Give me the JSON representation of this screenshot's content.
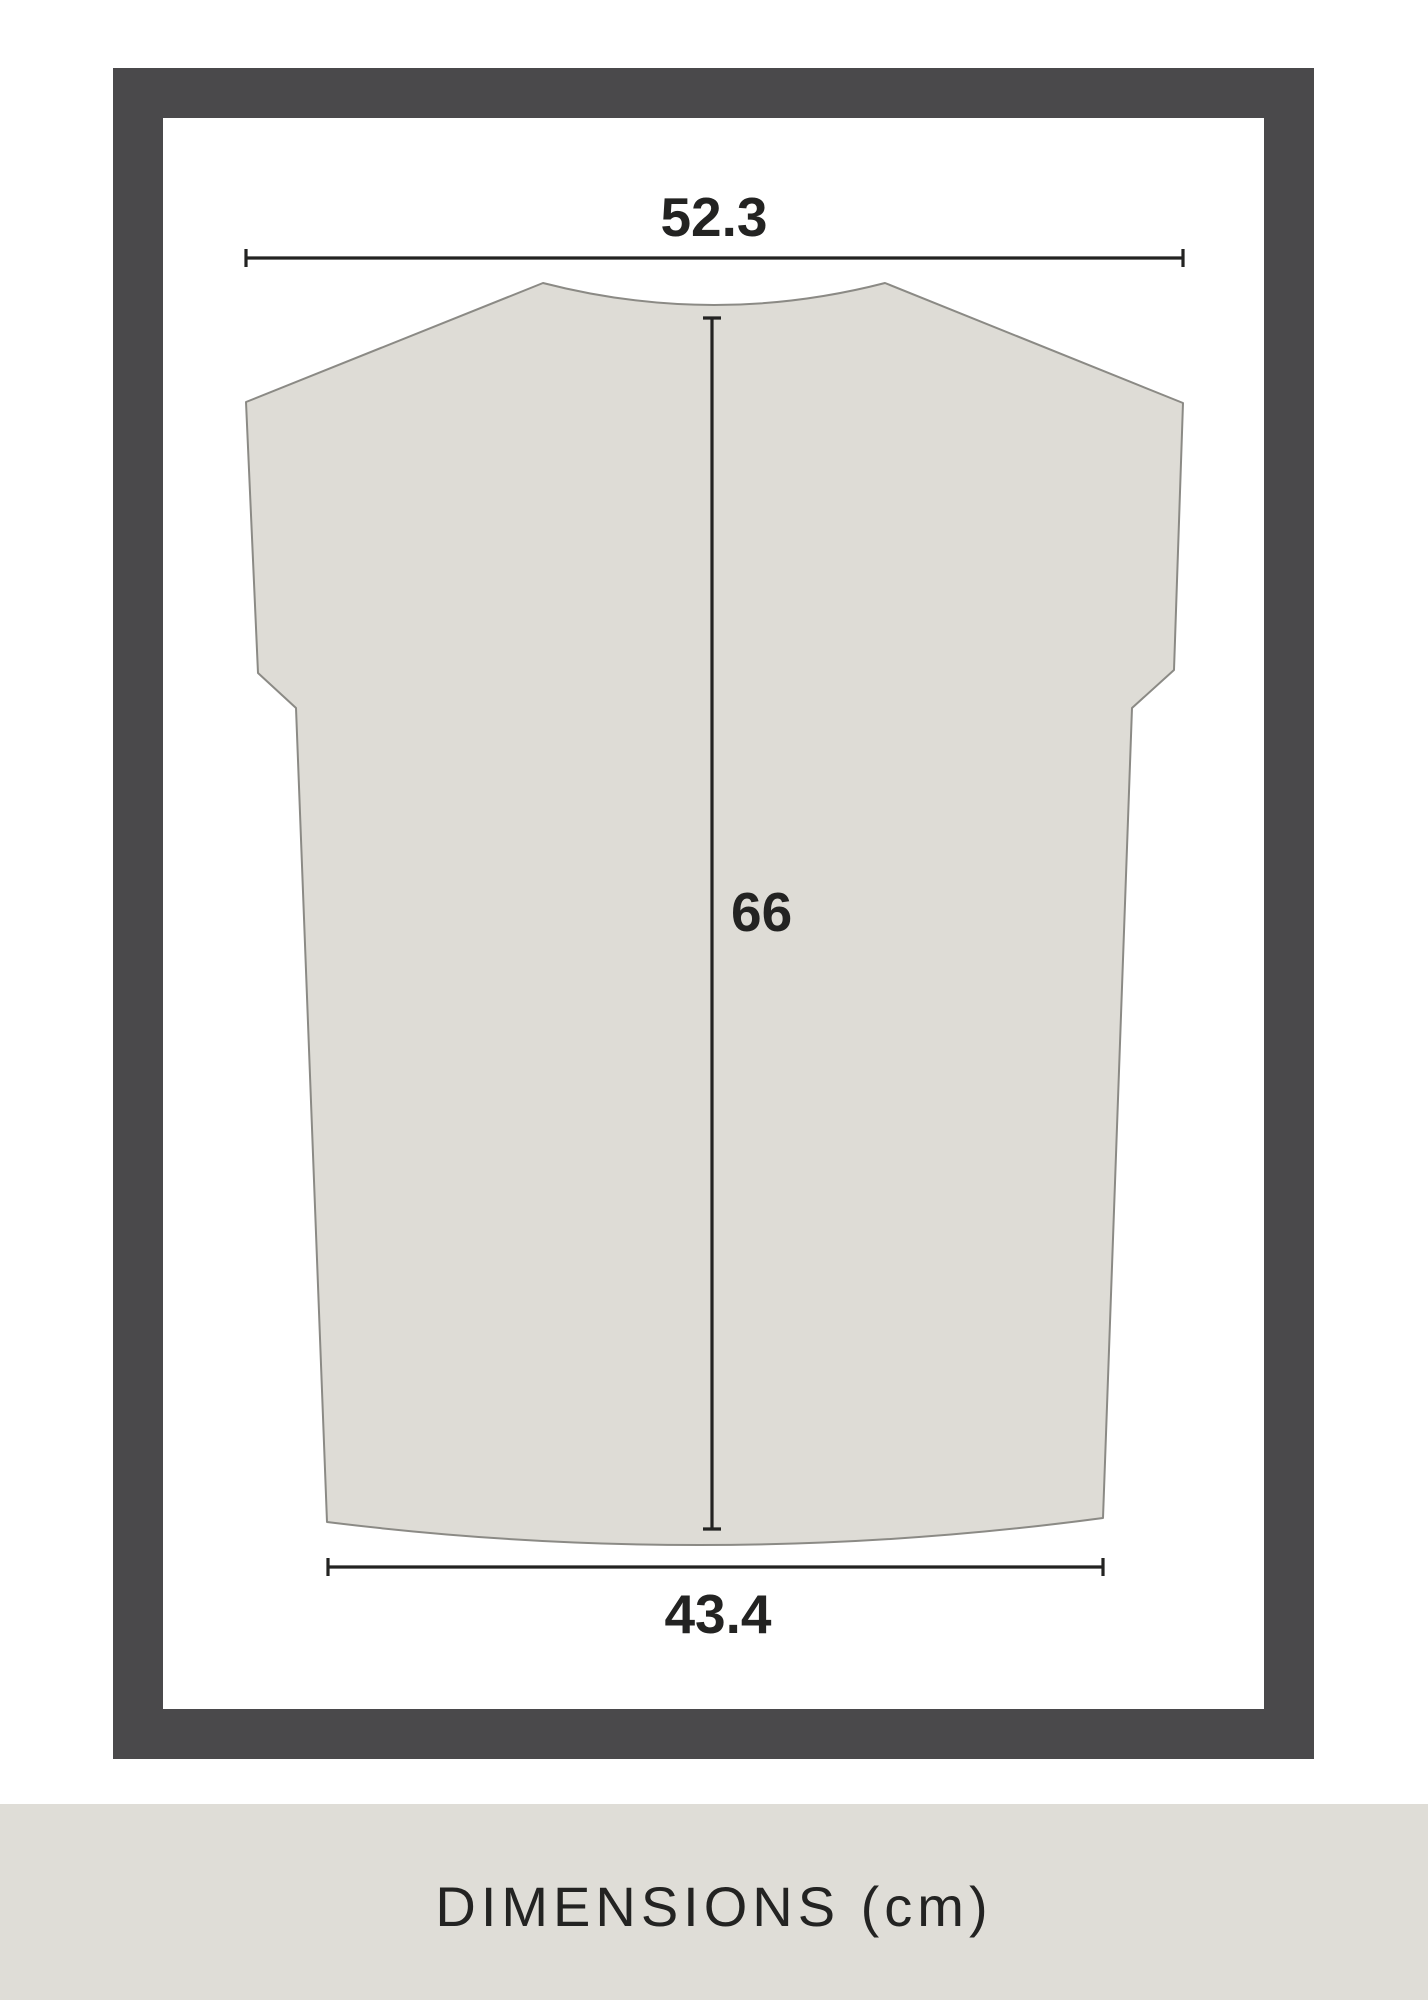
{
  "diagram": {
    "measurements": {
      "top_width": "52.3",
      "length": "66",
      "bottom_width": "43.4"
    },
    "unit": "cm"
  },
  "footer": {
    "title": "DIMENSIONS (cm)"
  },
  "colors": {
    "page-bg": "#ffffff",
    "frame": "#4a494b",
    "shirt-fill": "#dedcd6",
    "shirt-stroke": "#8b8a85",
    "ink": "#232322",
    "footer-bg": "#dfddd7"
  }
}
